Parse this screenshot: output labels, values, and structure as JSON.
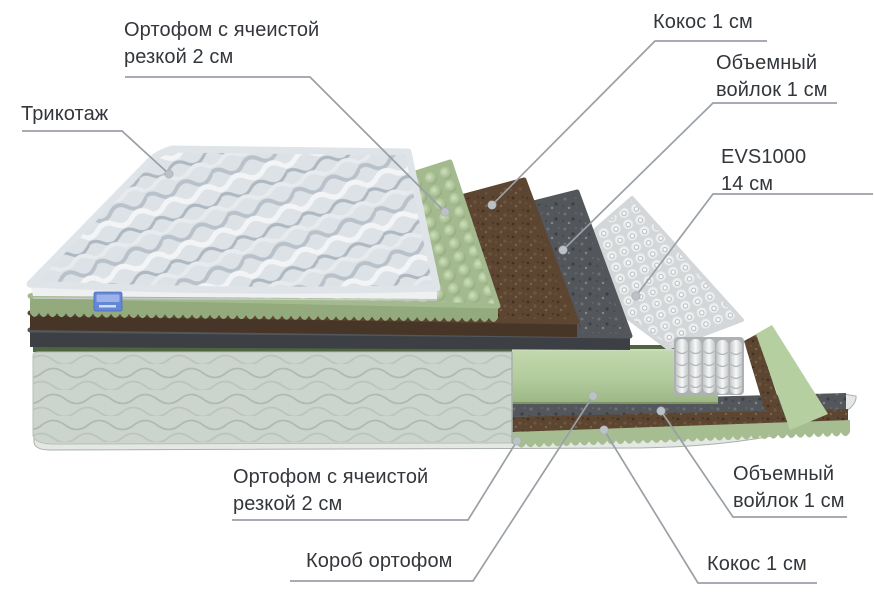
{
  "diagram_type": "mattress-layers-cutaway-diagram",
  "labels": {
    "ortofom_top": {
      "line1": "Ортофом с ячеистой",
      "line2": "резкой 2 см"
    },
    "trikotazh": {
      "line1": "Трикотаж"
    },
    "kokos_top": {
      "line1": "Кокос 1 см"
    },
    "voylok_top": {
      "line1": "Объемный",
      "line2": "войлок 1 см"
    },
    "evs": {
      "line1": "EVS1000",
      "line2": "14 см"
    },
    "ortofom_bottom": {
      "line1": "Ортофом с ячеистой",
      "line2": "резкой 2 см"
    },
    "korob": {
      "line1": "Короб ортофом"
    },
    "voylok_bottom": {
      "line1": "Объемный",
      "line2": "войлок 1 см"
    },
    "kokos_bottom": {
      "line1": "Кокос 1 см"
    }
  },
  "layers": [
    {
      "name": "Трикотаж",
      "size": ""
    },
    {
      "name": "Ортофом с ячеистой резкой",
      "size": "2 см"
    },
    {
      "name": "Кокос",
      "size": "1 см"
    },
    {
      "name": "Объемный войлок",
      "size": "1 см"
    },
    {
      "name": "EVS1000",
      "size": "14 см"
    },
    {
      "name": "Короб ортофом",
      "size": ""
    },
    {
      "name": "Объемный войлок",
      "size": "1 см"
    },
    {
      "name": "Кокос",
      "size": "1 см"
    },
    {
      "name": "Ортофом с ячеистой резкой",
      "size": "2 см"
    }
  ],
  "colors": {
    "background": "#ffffff",
    "text": "#33373c",
    "leader_line": "#9aa0a6",
    "leader_dot": "#bcc1c6",
    "quilt_fabric": "#dde2e7",
    "foam_green": "#a9bf94",
    "coconut_brown": "#5c4632",
    "felt_gray": "#53565a",
    "springs_white": "#e8eaeb",
    "box_green": "#b2cb9c",
    "body_fabric": "#ccd4ce",
    "tag_blue": "#6487d8"
  }
}
